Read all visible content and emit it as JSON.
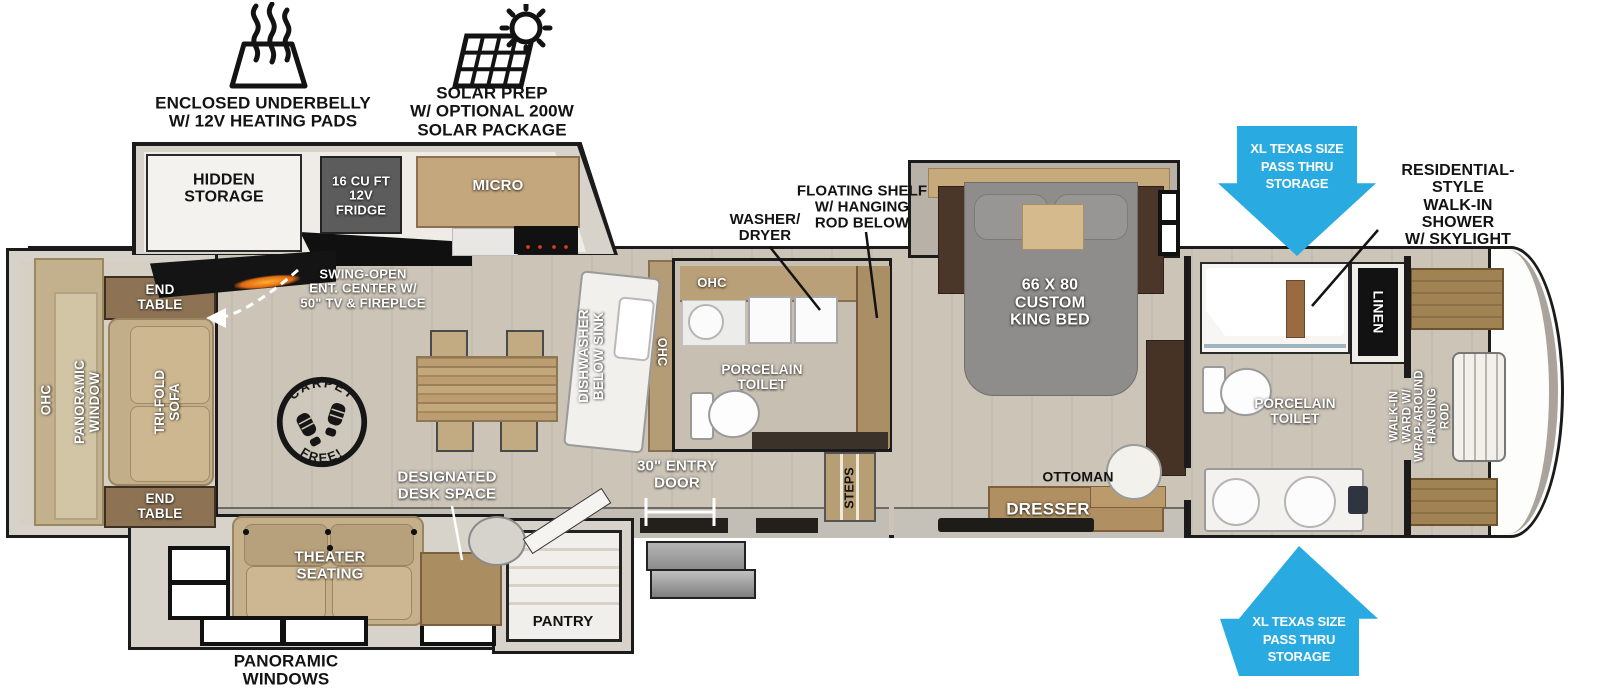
{
  "diagram_type": "rv-floorplan",
  "colors": {
    "accent_blue": "#29ABE2",
    "wall_black": "#1b1b1b",
    "floor": "#cbc4b7",
    "exterior_band": "#d8d3ca",
    "cabinet_wood": "#b99e76",
    "dark_wood": "#4f3b2b",
    "sofa_tan": "#c3ae8a",
    "bed_gray": "#8e8d8b",
    "white_fixture": "#f4f2ee"
  },
  "icons": {
    "heat": "heating-pads-icon",
    "solar": "solar-prep-icon",
    "arrow_down": "pass-thru-arrow-down",
    "arrow_up": "pass-thru-arrow-up",
    "carpet_badge": "carpet-free-badge"
  },
  "features": {
    "underbelly": "ENCLOSED UNDERBELLY\nW/ 12V HEATING PADS",
    "solar": "SOLAR PREP\nW/ OPTIONAL 200W\nSOLAR PACKAGE"
  },
  "badge": {
    "top": "CARPET",
    "bottom": "FREE!"
  },
  "labels": {
    "hidden_storage": "HIDDEN\nSTORAGE",
    "fridge": "16 CU FT\n12V\nFRIDGE",
    "micro": "MICRO",
    "ent_center": "SWING-OPEN\nENT. CENTER W/\n50\" TV & FIREPLCE",
    "end_table_top": "END\nTABLE",
    "end_table_bottom": "END\nTABLE",
    "ohc_left": "OHC",
    "panoramic_window": "PANORAMIC\nWINDOW",
    "trifold_sofa": "TRI-FOLD\nSOFA",
    "theater_seating": "THEATER\nSEATING",
    "designated_desk": "DESIGNATED\nDESK SPACE",
    "pantry": "PANTRY",
    "panoramic_windows": "PANORAMIC\nWINDOWS",
    "dishwasher": "DISHWASHER\nBELOW SINK",
    "ohc_island": "OHC",
    "ohc_midbath": "OHC",
    "porcelain_toilet_mid": "PORCELAIN\nTOILET",
    "washer_dryer": "WASHER/\nDRYER",
    "floating_shelf": "FLOATING SHELF\nW/ HANGING\nROD BELOW",
    "entry_door": "30\" ENTRY\nDOOR",
    "steps": "STEPS",
    "king_bed": "66 X 80\nCUSTOM\nKING BED",
    "ottoman": "OTTOMAN",
    "dresser": "DRESSER",
    "pass_thru_top": "XL TEXAS SIZE\nPASS THRU\nSTORAGE",
    "pass_thru_bottom": "XL TEXAS SIZE\nPASS THRU\nSTORAGE",
    "shower": "RESIDENTIAL-STYLE\nWALK-IN SHOWER\nW/ SKYLIGHT",
    "linen": "LINEN",
    "porcelain_toilet_front": "PORCELAIN\nTOILET",
    "walk_in_ward": "WALK-IN\nWARD W/\nWRAP-AROUND\nHANGING\nROD"
  }
}
